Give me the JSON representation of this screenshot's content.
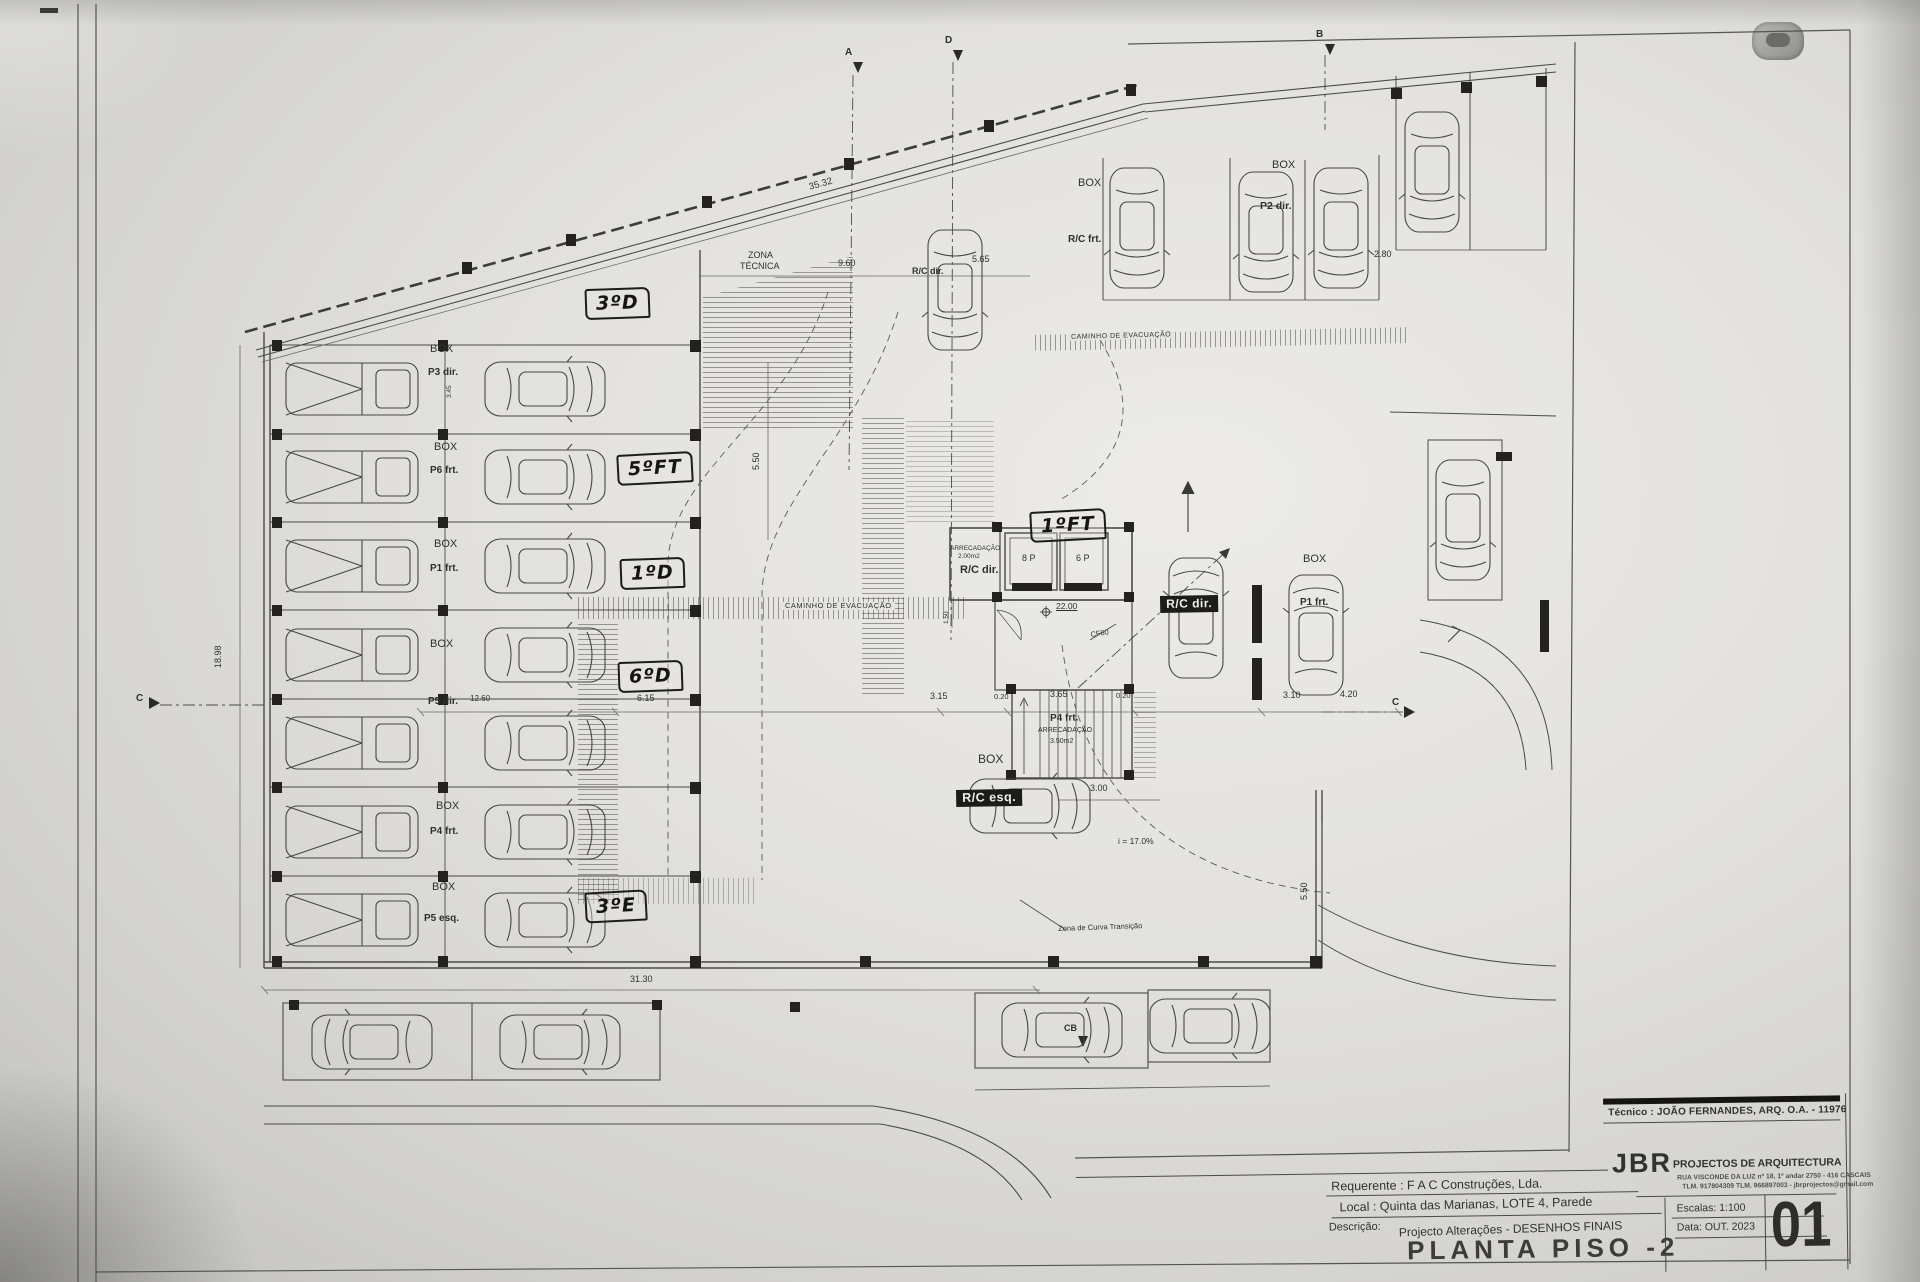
{
  "titleblock": {
    "tecnico": "Técnico : JOÃO FERNANDES, ARQ.   O.A. - 11976",
    "firm_initials": "JBR",
    "firm_name": "PROJECTOS DE ARQUITECTURA",
    "firm_address": "RUA VISCONDE DA LUZ nº 18, 1º andar  2750 - 416  CASCAIS",
    "firm_contacts": "TLM. 917804309 TLM. 966897003 - jbrprojectos@gmail.com",
    "requerente": "Requerente : F A C  Construções, Lda.",
    "local": "Local : Quinta das Marianas, LOTE 4, Parede",
    "descricao_label": "Descrição:",
    "descricao": "Projecto Alterações - DESENHOS FINAIS",
    "drawing_title": "PLANTA PISO -2",
    "escalas": "Escalas:  1:100",
    "data": "Data: OUT.  2023",
    "sheet_number": "01"
  },
  "plan": {
    "handwritten": [
      "3ºD",
      "5ºFT",
      "1ºD",
      "6ºD",
      "3ºE",
      "1ºFT"
    ],
    "box": "BOX",
    "units": {
      "p3dir": "P3 dir.",
      "p6frt": "P6 frt.",
      "p1frt": "P1 frt.",
      "p5dir": "P5 dir.",
      "p4frt": "P4 frt.",
      "p5esq": "P5 esq.",
      "p2dir": "P2 dir.",
      "p1frt_r": "P1 frt.",
      "rc_frt": "R/C frt.",
      "rc_dir_top": "R/C dir.",
      "rc_dir_small": "R/C dir.",
      "rc_dir_box": "R/C dir.",
      "rc_esq_box": "R/C esq.",
      "p4frt_stair": "P4 frt."
    },
    "rooms": {
      "zona1": "ZONA",
      "zona2": "TÉCNICA",
      "arrec1a": "ARRECADAÇÃO",
      "arrec1b": "2.00m2",
      "arrec2a": "ARRECADAÇÃO",
      "arrec2b": "3.50m2",
      "elev8": "8 P",
      "elev6": "6 P",
      "cf60": "CF60"
    },
    "paths": {
      "caminho": "CAMINHO DE EVACUAÇÃO",
      "curva": "Zona de Curva Transição",
      "slope": "i = 17.0%",
      "level": "22.00"
    },
    "dims": {
      "d1": "35.32",
      "d2": "9.60",
      "d3": "5.65",
      "d4": "2.80",
      "d5": "5.50",
      "d6": "6.15",
      "d7": "3.15",
      "d8": "0.20",
      "d9": "3.65",
      "d10": "0.20",
      "d11": "3.10",
      "d12": "4.20",
      "d13": "3.00",
      "d14": "5.50",
      "d15": "31.30",
      "d16": "12.60",
      "d17": "18.98",
      "d18": "3.45",
      "d19": "1.50"
    },
    "markers": {
      "a": "A",
      "d": "D",
      "b": "B",
      "c": "C",
      "cb": "CB"
    }
  }
}
